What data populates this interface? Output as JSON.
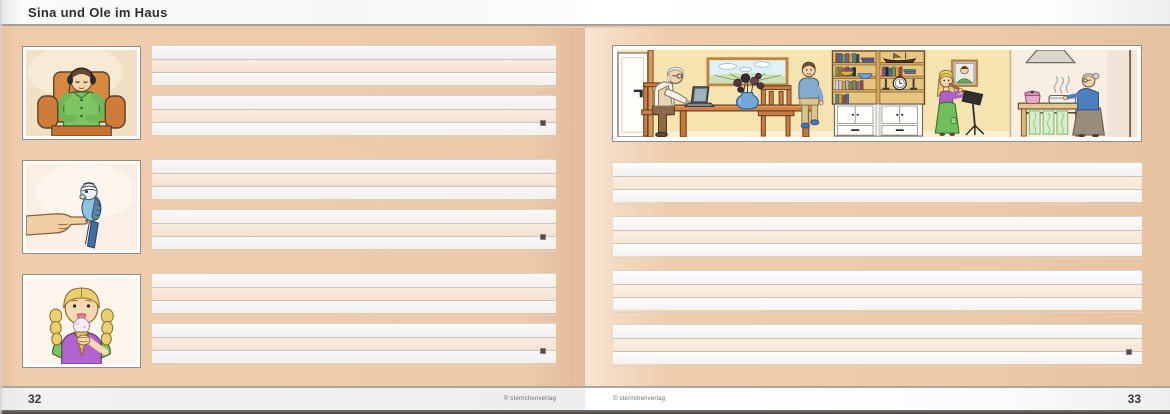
{
  "header": {
    "title": "Sina und Ole im Haus"
  },
  "left_page": {
    "page_number": "32",
    "copyright": "© sternchenverlag"
  },
  "right_page": {
    "page_number": "33",
    "copyright": "© sternchenverlag"
  },
  "illustrations": {
    "headphones_alt": "Child with headphones relaxing in an orange armchair",
    "budgie_alt": "Blue budgie perched on an outstretched finger",
    "icecream_alt": "Girl with blonde braids licking an ice cream cone",
    "livingroom_alt": "Living room scene: man working on a laptop at the table, boy sitting on the table, bookshelf with cabinet, girl playing the recorder at a music stand, grandmother cooking in the kitchen"
  },
  "colors": {
    "page_background": "#ecc9a9",
    "line_tint": "#f7e8da",
    "line_marker": "#4f4c49"
  }
}
